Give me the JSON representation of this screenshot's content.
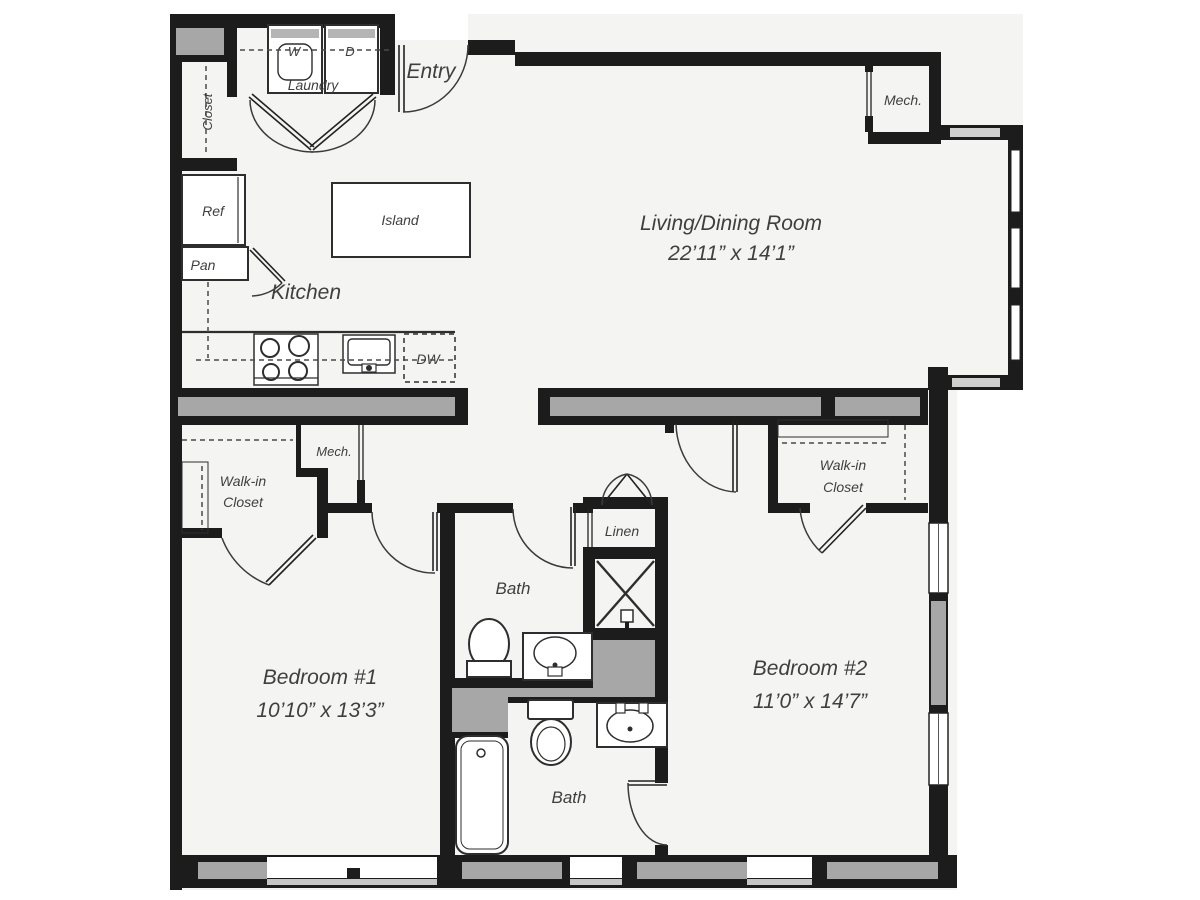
{
  "plan": {
    "rooms": {
      "living": {
        "name": "Living/Dining Room",
        "dims": "22’11” x 14’1”"
      },
      "bedroom1": {
        "name": "Bedroom #1",
        "dims": "10’10” x 13’3”"
      },
      "bedroom2": {
        "name": "Bedroom #2",
        "dims": "11’0” x 14’7”"
      },
      "kitchen": {
        "name": "Kitchen"
      },
      "entry": {
        "name": "Entry"
      },
      "laundry": {
        "name": "Laundry"
      },
      "bath_upper": {
        "name": "Bath"
      },
      "bath_lower": {
        "name": "Bath"
      },
      "linen": {
        "name": "Linen"
      },
      "closet_entry": {
        "name": "Closet"
      },
      "walk_in_closet_1": {
        "line1": "Walk-in",
        "line2": "Closet"
      },
      "walk_in_closet_2": {
        "line1": "Walk-in",
        "line2": "Closet"
      },
      "mech_upper": {
        "name": "Mech."
      },
      "mech_hall": {
        "name": "Mech."
      }
    },
    "fixtures": {
      "washer": "W",
      "dryer": "D",
      "dishwasher": "DW",
      "refrigerator": "Ref",
      "pantry": "Pan",
      "island": "Island"
    },
    "colors": {
      "wall": "#1c1c1c",
      "structural_gray": "#a7a7a7",
      "window_sill": "#c6c6c6",
      "floor": "#ffffff",
      "text": "#3f3f3f"
    }
  }
}
